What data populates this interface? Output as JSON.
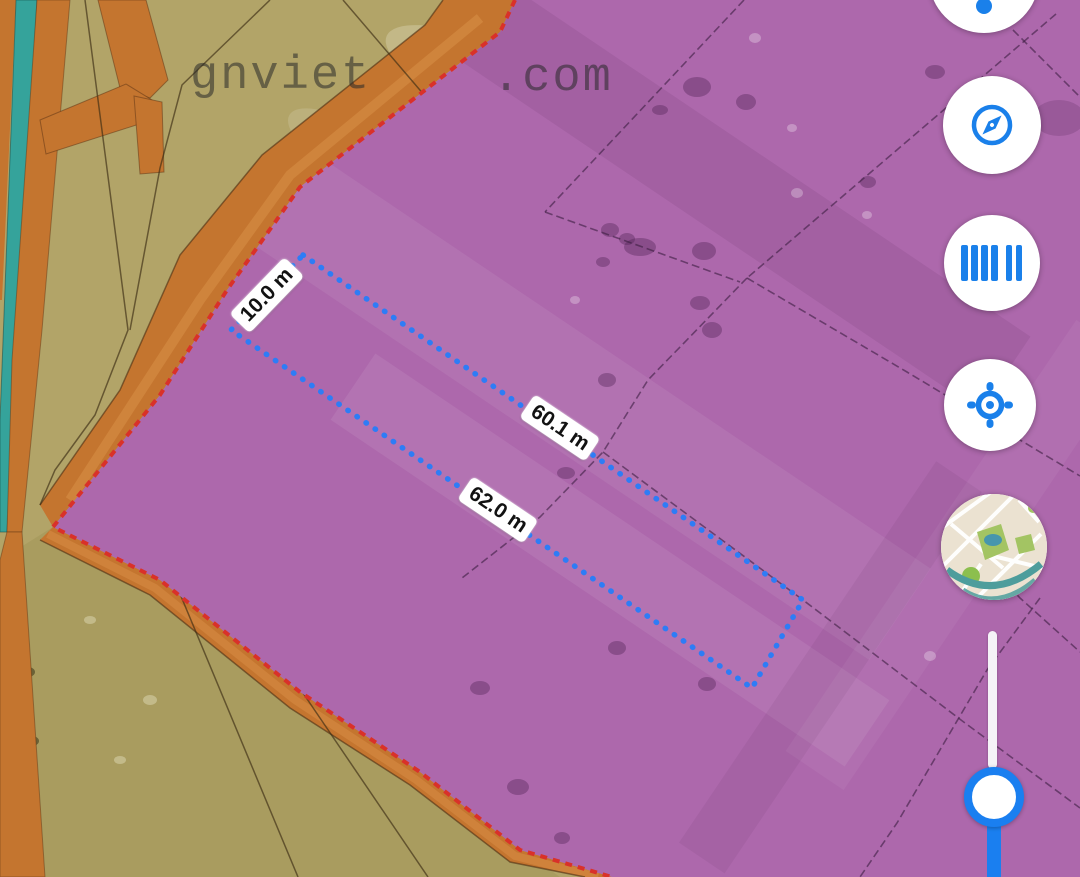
{
  "app": {
    "type": "land-planning-map-viewer"
  },
  "watermark": {
    "part1": "gnviet",
    "part2": ".com"
  },
  "measurements": {
    "short": "10.0 m",
    "top": "60.1 m",
    "bottom": "62.0 m",
    "unit": "m",
    "values": [
      10.0,
      60.1,
      62.0
    ]
  },
  "toolbar": {
    "buttons": [
      {
        "name": "marker",
        "icon": "marker-dot-icon"
      },
      {
        "name": "compass",
        "icon": "compass-icon"
      },
      {
        "name": "barcode-scan",
        "icon": "barcode-icon"
      },
      {
        "name": "my-location",
        "icon": "locate-icon"
      },
      {
        "name": "basemap-switcher",
        "icon": "basemap-thumbnail"
      }
    ]
  },
  "slider": {
    "orientation": "vertical",
    "knob_position": "bottom"
  },
  "colors": {
    "accent_blue": "#1a80ea",
    "measure_blue": "#2e7cf6",
    "slider_blue": "#1a7ff0",
    "zone_purple": "#ad68ac",
    "land_tan": "#b2a468",
    "road_orange": "#c4752f",
    "canal_teal": "#35a39b",
    "boundary_red": "#d93129"
  }
}
